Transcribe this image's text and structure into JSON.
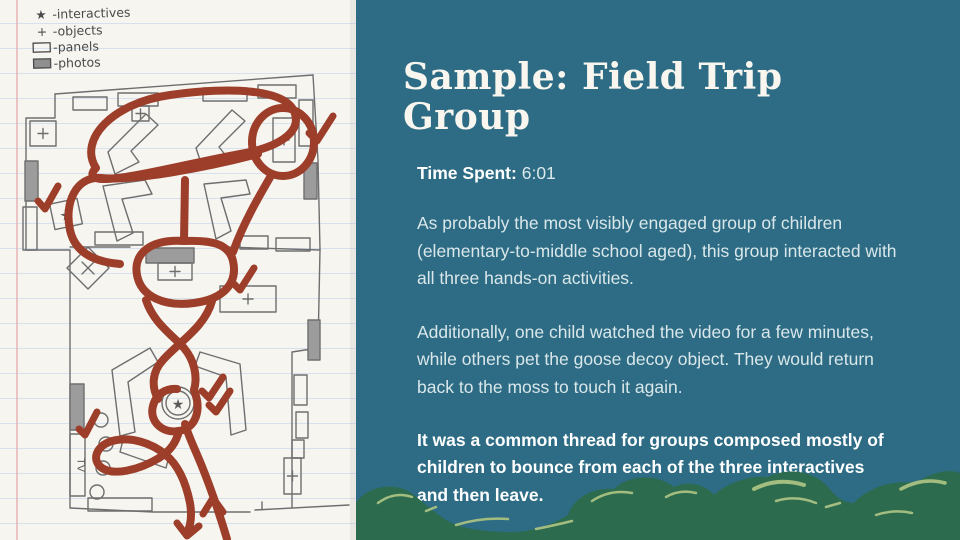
{
  "slide": {
    "title": "Sample: Field Trip Group",
    "time": {
      "label": "Time Spent:",
      "value": "6:01"
    },
    "paragraphs": [
      "As probably the most visibly engaged group of children (elementary-to-middle school aged), this group interacted with all three hands-on activities.",
      "Additionally, one child watched the video for a few minutes, while others pet the goose decoy object. They would return back to the moss to touch it again.",
      "It was a common thread for groups composed mostly of children to bounce from each of the three interactives and then leave."
    ]
  },
  "map": {
    "legend": {
      "items": [
        {
          "glyph": "★",
          "label": "-interactives"
        },
        {
          "glyph": "+",
          "label": "-objects"
        },
        {
          "glyph": "",
          "label": "-panels"
        },
        {
          "glyph": "",
          "label": "-photos"
        }
      ]
    },
    "tv_label": "TV",
    "star_glyph": "★"
  },
  "colors": {
    "panel_teal": "#2d6c84",
    "path_red": "#9d3e2a",
    "pencil_grey": "#6e6e6e",
    "paper": "#f6f5f0",
    "bush_green": "#2d6b4e",
    "bush_highlight": "#a3bd80",
    "title_text": "#f8f6ef",
    "body_text": "#d9e7ea"
  }
}
